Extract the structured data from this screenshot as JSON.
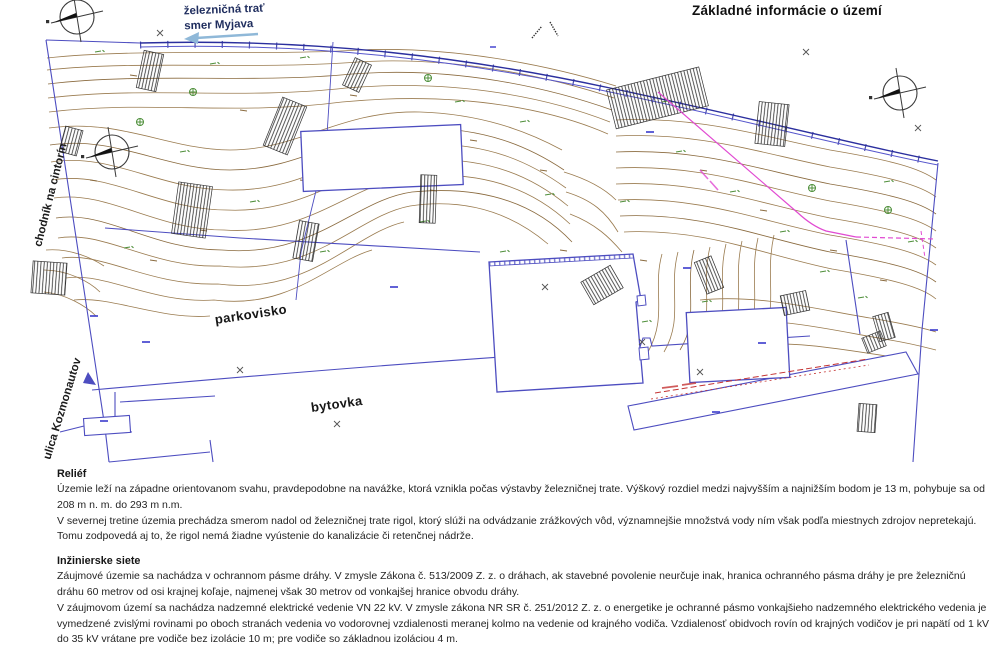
{
  "title": "Základné informácie o území",
  "map": {
    "railway_label_line1": "železničná trať",
    "railway_label_line2": "smer Myjava",
    "street_label_path_to_cemetery": "chodník na cintorín",
    "street_label_street": "ulica Kozmonautov",
    "area_label_parking": "parkovisko",
    "area_label_apartment_building": "bytovka",
    "symbols": {
      "north_arrow": "compass-north-arrow",
      "direction_arrow": "left-pointing-arrow",
      "survey_mark": "cross-mark"
    },
    "colors": {
      "contour_brown": "#9a7b4f",
      "parcel_blue": "#4d4dc0",
      "railway_blue": "#2b2f9e",
      "power_line_magenta": "#e14ad2",
      "boundary_red": "#c43333",
      "elevation_green": "#4e8f3a",
      "direction_arrow_blue": "#8fb8d8"
    }
  },
  "sections": [
    {
      "heading": "Reliéf",
      "paragraphs": [
        "Územie leží na západne orientovanom svahu, pravdepodobne na navážke, ktorá vznikla počas výstavby železničnej trate. Výškový rozdiel medzi najvyšším a najnižším bodom je 13 m, pohybuje sa od 208 m n. m. do 293 m n.m.",
        "V severnej tretine územia prechádza smerom nadol od železničnej trate rigol, ktorý slúži na odvádzanie zrážkových vôd, významnejšie množstvá vody ním však podľa miestnych zdrojov nepretekajú. Tomu zodpovedá aj to, že rigol nemá žiadne vyústenie do kanalizácie či retenčnej nádrže."
      ]
    },
    {
      "heading": "Inžinierske siete",
      "paragraphs": [
        "Záujmové územie sa nachádza v ochrannom pásme dráhy. V zmysle Zákona č. 513/2009 Z. z. o dráhach, ak stavebné povolenie neurčuje inak, hranica ochranného pásma dráhy je pre železničnú dráhu 60 metrov od osi krajnej koľaje, najmenej však 30 metrov od vonkajšej hranice obvodu dráhy.",
        "V záujmovom území sa nachádza nadzemné elektrické vedenie VN 22 kV. V zmysle zákona NR SR č. 251/2012 Z. z. o energetike je ochranné pásmo vonkajšieho nadzemného elektrického vedenia je vymedzené zvislými rovinami po oboch stranách vedenia vo vodorovnej vzdialenosti meranej kolmo na vedenie od krajného vodiča. Vzdialenosť obidvoch rovín od krajných vodičov je pri napätí od 1 kV do 35 kV vrátane pre vodiče bez izolácie 10 m; pre vodiče so základnou izoláciou 4 m."
      ]
    }
  ]
}
